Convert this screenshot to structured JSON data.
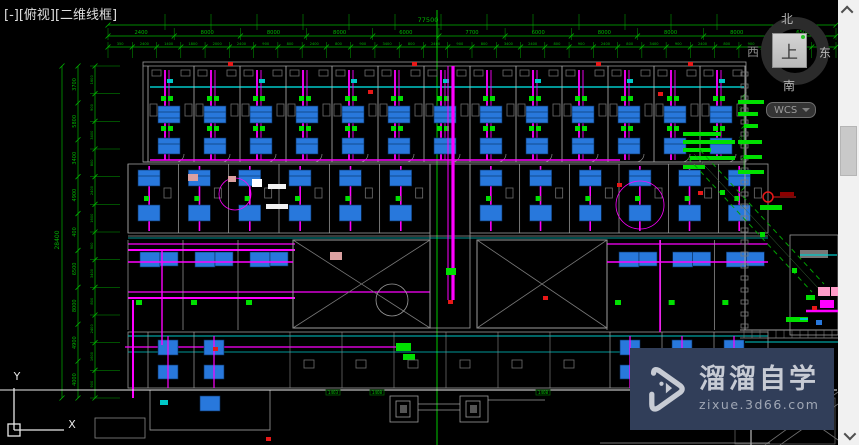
{
  "viewport_label": "[-][俯视][二维线框]",
  "viewcube": {
    "north": "北",
    "south": "南",
    "east": "东",
    "west": "西",
    "top_face": "上"
  },
  "wcs": {
    "label": "WCS"
  },
  "ucs": {
    "x": "X",
    "y": "Y"
  },
  "watermark": {
    "brand": "溜溜自学",
    "site": "zixue.3d66.com"
  },
  "dims": {
    "overall_width": "77500",
    "overall_height": "28400",
    "top_axis": [
      "2400",
      "8000",
      "8000",
      "8000",
      "6000",
      "7700",
      "6000",
      "8000",
      "8000",
      "8000",
      "6500"
    ],
    "top_detail": [
      "350",
      "2400",
      "1400",
      "1800",
      "2000",
      "2400",
      "900",
      "800",
      "2400",
      "800",
      "900",
      "3400",
      "800",
      "2400",
      "900",
      "800",
      "3400",
      "2400",
      "800",
      "900",
      "2400",
      "800",
      "3400",
      "900",
      "2400",
      "800",
      "900",
      "2400",
      "800",
      "2400"
    ],
    "left_axis": [
      "3700",
      "5800",
      "3400",
      "4900",
      "400",
      "6500",
      "8000",
      "4900",
      "4000"
    ],
    "left_detail": [
      "1600",
      "900",
      "3400",
      "800",
      "2400",
      "1600",
      "900",
      "3400",
      "800",
      "2400",
      "1600",
      "900"
    ],
    "right_axis": [
      "300",
      "3700",
      "320"
    ],
    "axis_tags": [
      "1403",
      "1408",
      "1408",
      "1408"
    ]
  },
  "plan": {
    "band1_modules": 13,
    "band2_modules": 6,
    "wing_modules": 3,
    "colors": {
      "dim": "#00b400",
      "bright_green": "#00e000",
      "magenta": "#ff00ff",
      "cyan": "#00c8c8",
      "unit_blue": "#2878dc",
      "unit_blue_dark": "#0b3c78",
      "wall": "#9c9c9c",
      "wall_dim": "#6f6f6f",
      "white": "#ededed",
      "red": "#e81818",
      "dark_red": "#8c0000",
      "pink": "#ff9cc8",
      "salmon": "#dba0a0"
    }
  }
}
